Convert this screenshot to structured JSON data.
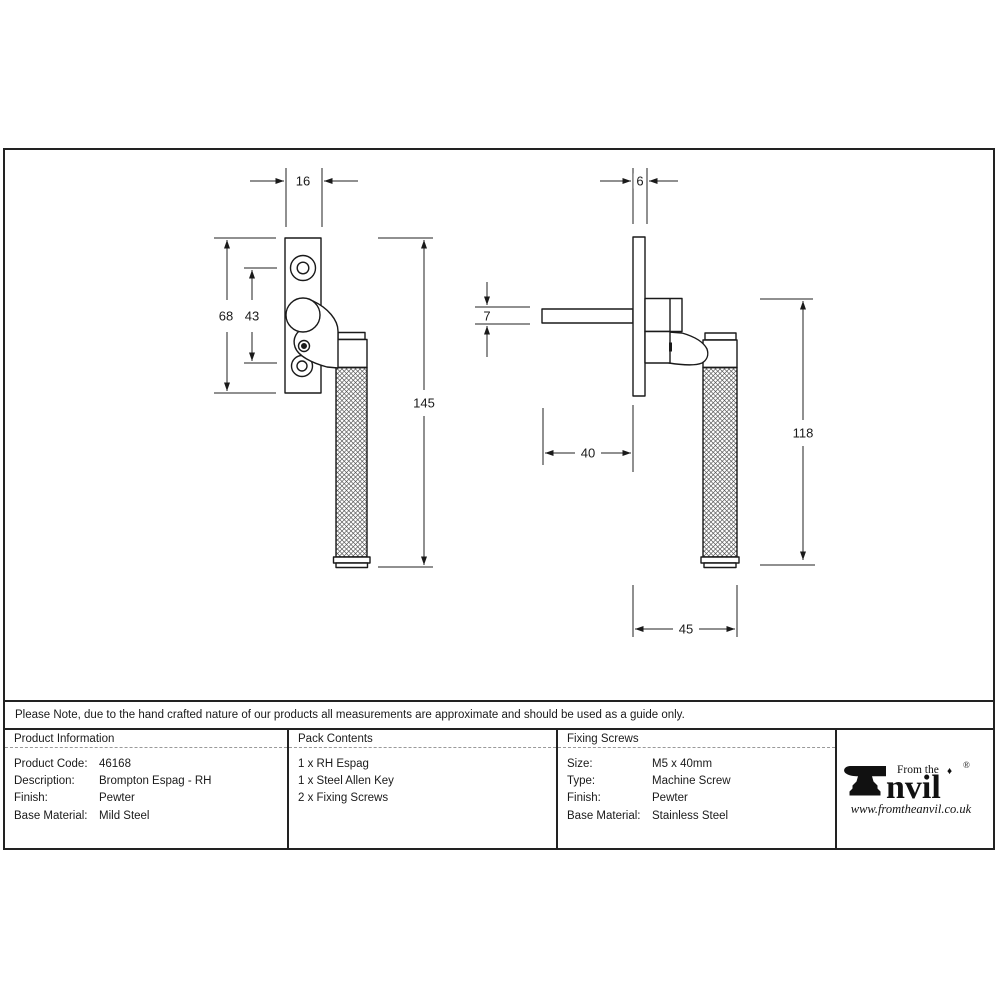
{
  "note": "Please Note, due to the hand crafted nature of our products all measurements are approximate and should be used as a guide only.",
  "dims": {
    "front": {
      "plate_width": "16",
      "plate_height": "68",
      "hole_spacing": "43",
      "overall_length": "145"
    },
    "side": {
      "plate_thickness": "6",
      "spindle_section": "7",
      "spindle_length": "40",
      "handle_drop": "118",
      "projection": "45"
    }
  },
  "table": {
    "product_info": {
      "header": "Product Information",
      "rows": [
        {
          "label": "Product Code:",
          "value": "46168"
        },
        {
          "label": "Description:",
          "value": "Brompton Espag - RH"
        },
        {
          "label": "Finish:",
          "value": "Pewter"
        },
        {
          "label": "Base Material:",
          "value": "Mild Steel"
        }
      ]
    },
    "pack_contents": {
      "header": "Pack Contents",
      "items": [
        "1 x RH Espag",
        "1 x Steel Allen Key",
        "2 x Fixing Screws"
      ]
    },
    "fixing_screws": {
      "header": "Fixing Screws",
      "rows": [
        {
          "label": "Size:",
          "value": "M5 x 40mm"
        },
        {
          "label": "Type:",
          "value": "Machine Screw"
        },
        {
          "label": "Finish:",
          "value": "Pewter"
        },
        {
          "label": "Base Material:",
          "value": "Stainless Steel"
        }
      ]
    }
  },
  "logo": {
    "tagline": "From the",
    "brand_suffix": "nvil",
    "registered": "®",
    "website": "www.fromtheanvil.co.uk"
  },
  "colors": {
    "line": "#1a1a1a",
    "dashed_rule": "#9a9a9a"
  }
}
